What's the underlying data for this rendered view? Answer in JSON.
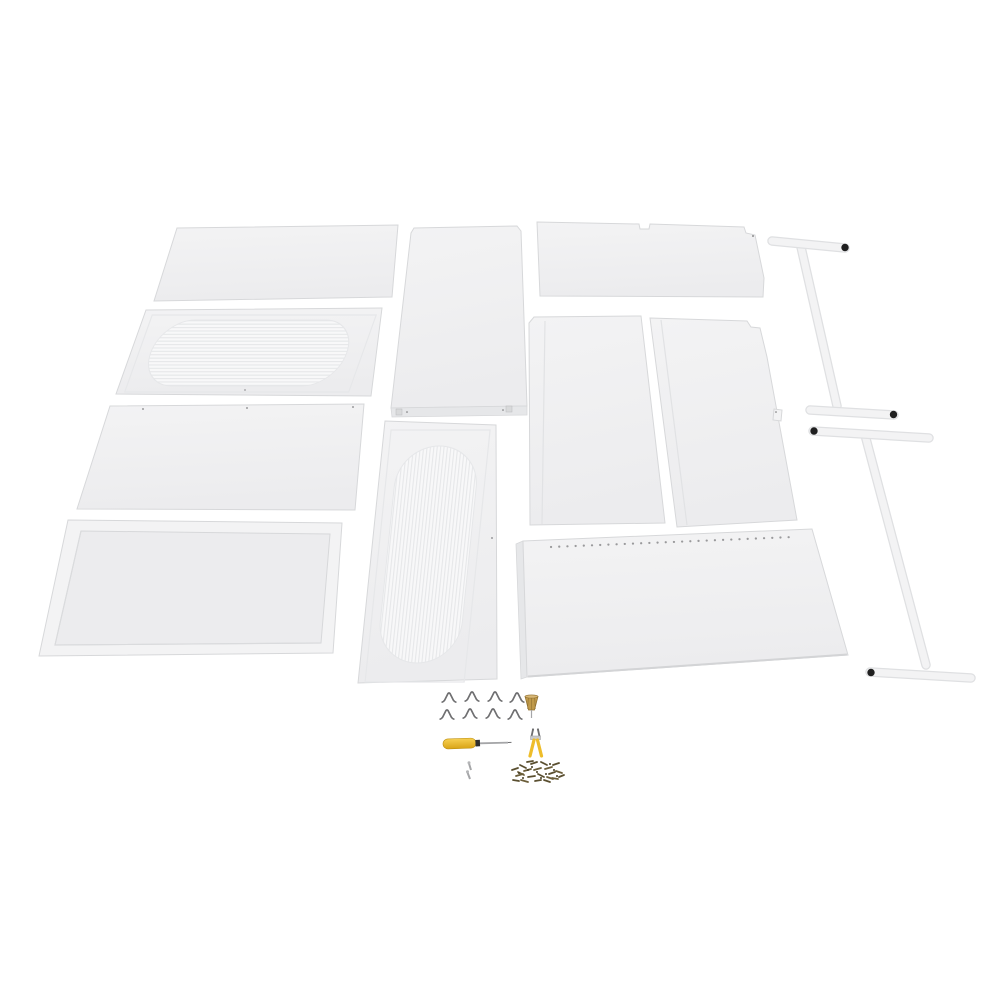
{
  "scene": {
    "type": "product-photo",
    "subject": "Unassembled white metal storage-cabinet / workbench kit laid out flat on a white background",
    "background_color": "#ffffff"
  },
  "colors": {
    "background": "#ffffff",
    "panel": "#ececee",
    "panel_light": "#f3f3f4",
    "panel_edge": "#d7d8da",
    "vent_bg": "#f8f8f9",
    "vent_line": "#e6e7e9",
    "tube": "#f3f3f4",
    "tube_edge": "#dfe0e2",
    "end_cap": "#202020",
    "clip": "#6f6f71",
    "brass": "#c09a4a",
    "brass_dark": "#8f6f30",
    "tool_yellow": "#eebd2a",
    "metal": "#a5a6a8",
    "screws": "#5a4f30",
    "hole": "#9a9a9c"
  },
  "parts": [
    {
      "name": "flat-top-panel",
      "count": 1
    },
    {
      "name": "horizontal-vent-panel",
      "count": 1
    },
    {
      "name": "flat-side-panel",
      "count": 1
    },
    {
      "name": "lipped-tray-shelf",
      "count": 1
    },
    {
      "name": "tall-flat-panel",
      "count": 1
    },
    {
      "name": "vertical-vent-panel",
      "count": 1
    },
    {
      "name": "notched-shelf-panel",
      "count": 1
    },
    {
      "name": "back-panel-left",
      "count": 1
    },
    {
      "name": "back-panel-right",
      "count": 1
    },
    {
      "name": "perforated-base-panel",
      "count": 1
    },
    {
      "name": "t-shaped-tube-leg",
      "count": 2
    },
    {
      "name": "black-tube-end-cap",
      "count": 4
    },
    {
      "name": "shelf-clip",
      "count": 8
    },
    {
      "name": "brass-anchor-bit",
      "count": 1
    },
    {
      "name": "screwdriver",
      "count": 1
    },
    {
      "name": "small-assembly-tool",
      "count": 1
    },
    {
      "name": "small-screw",
      "count": 2
    },
    {
      "name": "screw-pile",
      "count": 1
    }
  ]
}
